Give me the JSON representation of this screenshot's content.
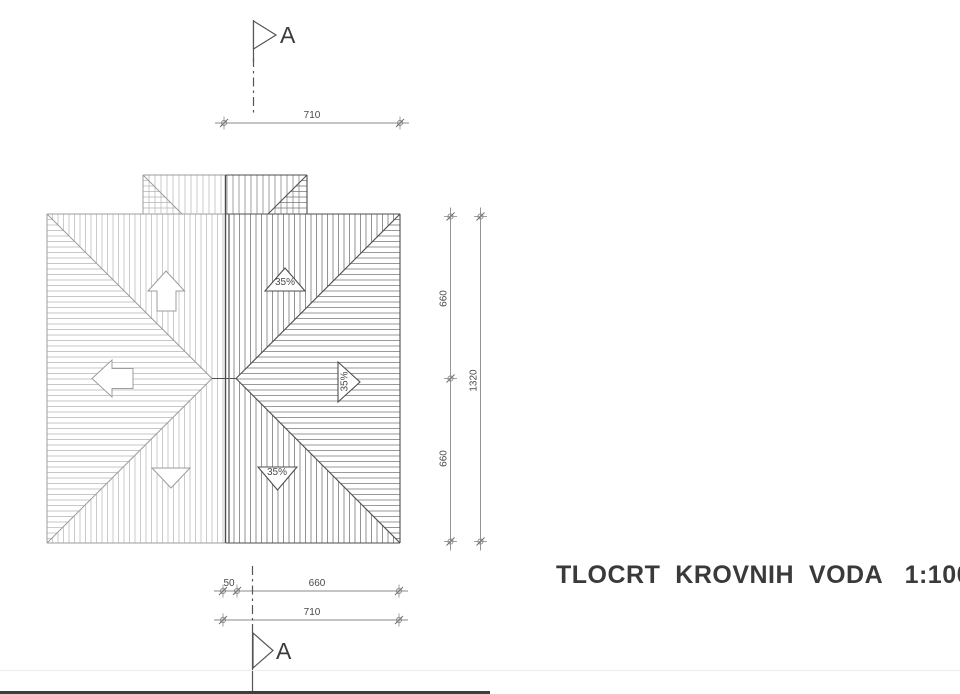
{
  "title": {
    "text": "TLOCRT  KROVNIH  VODA   1:100"
  },
  "section_markers": {
    "top_label": "A",
    "bottom_label": "A"
  },
  "slope_labels": {
    "top": "35%",
    "right": "35%",
    "bottom": "35%"
  },
  "dimensions": {
    "top_width": "710",
    "right_upper": "660",
    "right_lower": "660",
    "right_total": "1320",
    "bottom_offset": "50",
    "bottom_width": "660",
    "bottom_total": "710"
  },
  "colors": {
    "light": "#9c9c9c",
    "dark": "#4f4f4f",
    "hatchL": "#b5b5b5",
    "hatchR": "#787878",
    "dim": "#8a8a8a",
    "dimTick": "#6f6f6f",
    "section": "#555555",
    "pageEdge": "#ececec",
    "scanBar": "#3e3e3e"
  },
  "drawing": {
    "canvas": {
      "w": 960,
      "h": 694
    },
    "roof": {
      "x1": 47,
      "y1": 214,
      "x2": 400,
      "y2": 543,
      "ridge_y": 378.5,
      "ridge_x1": 212,
      "ridge_x2": 236,
      "split_x": 226,
      "hatch_step": 5.5
    },
    "dormer": {
      "x1": 143,
      "y1": 175,
      "x2": 307,
      "corner": 39,
      "hatch_step": 6
    },
    "heavy_lines": [
      {
        "x": 225.5,
        "y1": 175,
        "y2": 543,
        "w": 1.4,
        "c": "#4a4a4a"
      },
      {
        "x": 229.5,
        "y1": 214,
        "y2": 543,
        "w": 0.8,
        "c": "#7a7a7a"
      }
    ],
    "flow_arrows_plain": [
      [
        166,
        271,
        184.5,
        291,
        176,
        291,
        176,
        311,
        157,
        311,
        157,
        291,
        148,
        291
      ],
      [
        92,
        378.5,
        112,
        360,
        112,
        368.5,
        133,
        368.5,
        133,
        388.5,
        112,
        388.5,
        112,
        397
      ],
      [
        152,
        468,
        190,
        468,
        171,
        488
      ]
    ],
    "flow_arrows_labeled": [
      [
        285,
        268,
        305,
        291,
        265,
        291
      ],
      [
        338,
        362,
        360,
        382,
        338,
        402
      ],
      [
        258,
        467,
        297,
        467,
        277.5,
        490
      ]
    ],
    "dims": [
      {
        "o": "h",
        "pos": 123,
        "ticks": [
          224,
          400
        ]
      },
      {
        "o": "v",
        "pos": 450.5,
        "ticks": [
          216.5,
          378.5,
          541.5
        ]
      },
      {
        "o": "v",
        "pos": 480.5,
        "ticks": [
          216.5,
          541.5
        ]
      },
      {
        "o": "h",
        "pos": 591,
        "ticks": [
          223,
          237,
          399
        ]
      },
      {
        "o": "h",
        "pos": 620,
        "ticks": [
          223,
          399
        ]
      }
    ],
    "sections": {
      "top": {
        "x": 253.5,
        "solid": [
          20,
          62
        ],
        "dashdot": [
          58,
          113
        ],
        "flag": [
          253.5,
          21,
          276,
          35,
          253.5,
          49
        ]
      },
      "bottom": {
        "x": 252.5,
        "dashdot": [
          566,
          624
        ],
        "solid": [
          624,
          691
        ],
        "flag": [
          253,
          633,
          273,
          650.5,
          253,
          668
        ]
      }
    },
    "artifacts": {
      "page_edge_y": 670.5,
      "bar": {
        "x": 0,
        "y": 691,
        "w": 490,
        "h": 3
      }
    }
  }
}
